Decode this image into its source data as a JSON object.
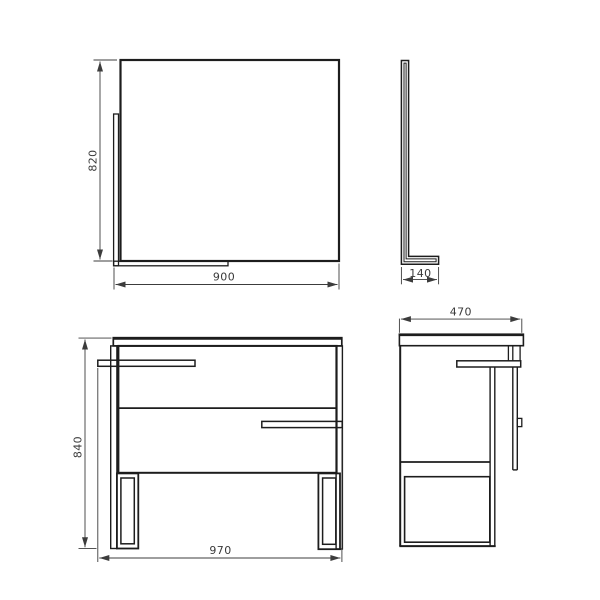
{
  "drawing": {
    "background": "#ffffff",
    "line_color": "#1d1d1d",
    "dim_color": "#3c3c3c",
    "views": {
      "mirror_front": {
        "height_mm": "820",
        "width_mm": "900"
      },
      "mirror_side": {
        "depth_mm": "140"
      },
      "cabinet_front": {
        "height_mm": "840",
        "width_mm": "970"
      },
      "cabinet_side": {
        "depth_mm": "470"
      }
    }
  }
}
